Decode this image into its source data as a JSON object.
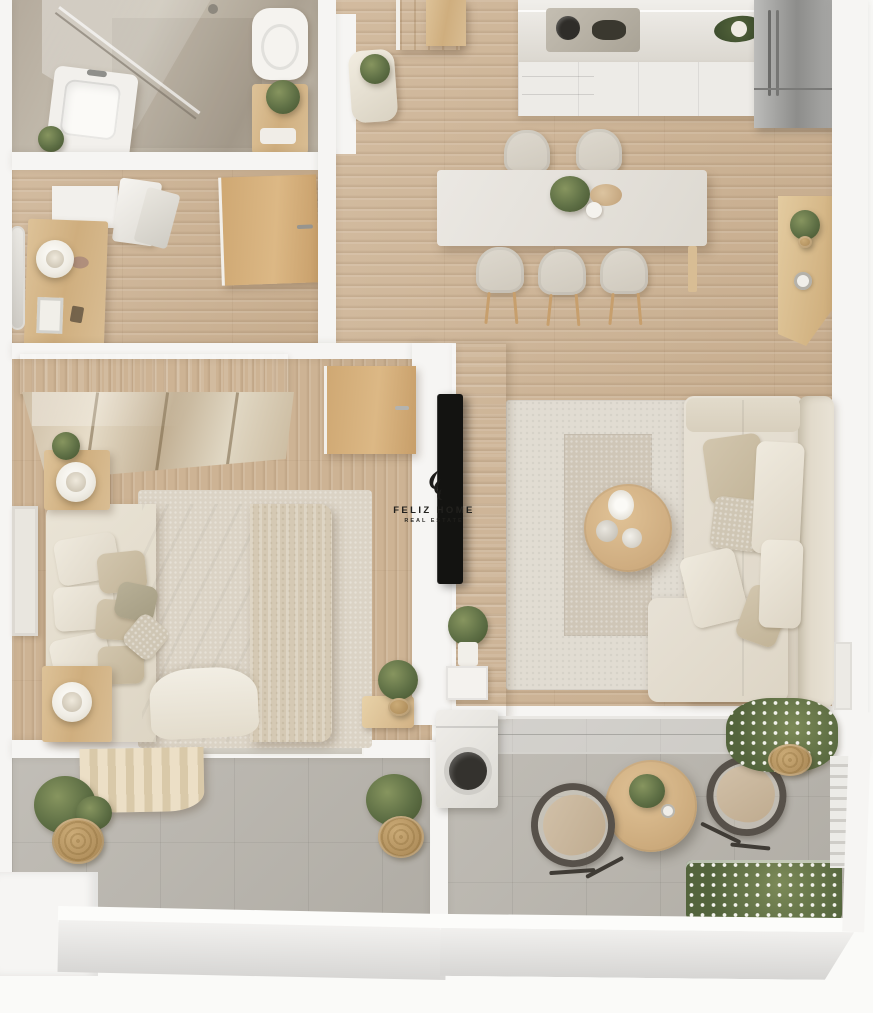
{
  "watermark": {
    "brand": "FELIZ HOME",
    "tagline": "REAL ESTATE"
  },
  "palette": {
    "background": "#fafaf8",
    "wall-white": "#f6f5f3",
    "wall-shadow": "#dbdad8",
    "wood-floor": "#cdb394",
    "wood-door": "#cfa873",
    "tile-balcony": "#b9b5ad",
    "marble-counter": "#e2ded6",
    "cabinet-white": "#edebe7",
    "steel-fridge": "#9e9e9c",
    "cream-sofa": "#e7e1d5",
    "beige-pillow": "#d2c6ae",
    "rug-outer": "#e1dcd2",
    "rug-inner": "#cfc6b7",
    "bed-linen": "#ebe6db",
    "throw-blanket": "#d5c9b4",
    "plant-green": "#5e6f45",
    "flower-white": "#f1f1ea",
    "tv-black": "#131311",
    "watermark-ink": "#22211e"
  },
  "scene": {
    "type": "3d-floor-plan-render",
    "view": "top-down",
    "rooms": [
      {
        "name": "bathroom",
        "items": [
          "walk-in-shower",
          "glass-partition",
          "vanity-sink",
          "toilet",
          "plant-table"
        ]
      },
      {
        "name": "entry-hall",
        "items": [
          "console-table",
          "table-lamp",
          "wall-mirror",
          "wall-cabinet",
          "towels",
          "bathroom-door",
          "entrance-door",
          "stool-with-plant"
        ]
      },
      {
        "name": "kitchen",
        "items": [
          "marble-countertop",
          "cooktop",
          "base-cabinets",
          "refrigerator",
          "serving-bowl",
          "tall-cabinet"
        ]
      },
      {
        "name": "dining-area",
        "items": [
          "dining-table",
          "dining-chair",
          "dining-chair",
          "dining-chair",
          "dining-chair",
          "dining-chair",
          "centerpiece-plant",
          "sideboard-with-plant"
        ]
      },
      {
        "name": "living-room",
        "items": [
          "corner-sofa",
          "throw-pillows",
          "area-rug",
          "inner-rug",
          "round-coffee-table",
          "wall-mounted-tv",
          "media-wall-panel",
          "plant-shelf",
          "window-ledge"
        ]
      },
      {
        "name": "bedroom",
        "items": [
          "double-bed",
          "pillows",
          "knit-throw",
          "nightstand",
          "nightstand",
          "table-lamp",
          "table-lamp",
          "mirrored-wardrobe",
          "bedroom-door",
          "wall-art-frame",
          "corner-plant",
          "bedside-rug"
        ]
      },
      {
        "name": "bedroom-balcony",
        "items": [
          "curtain",
          "sliding-window",
          "potted-plant",
          "potted-plant"
        ]
      },
      {
        "name": "terrace",
        "items": [
          "washing-machine",
          "glass-railing",
          "bistro-table",
          "lounge-chair",
          "lounge-chair",
          "flower-planter",
          "flower-planter",
          "flower-bed"
        ]
      }
    ]
  }
}
